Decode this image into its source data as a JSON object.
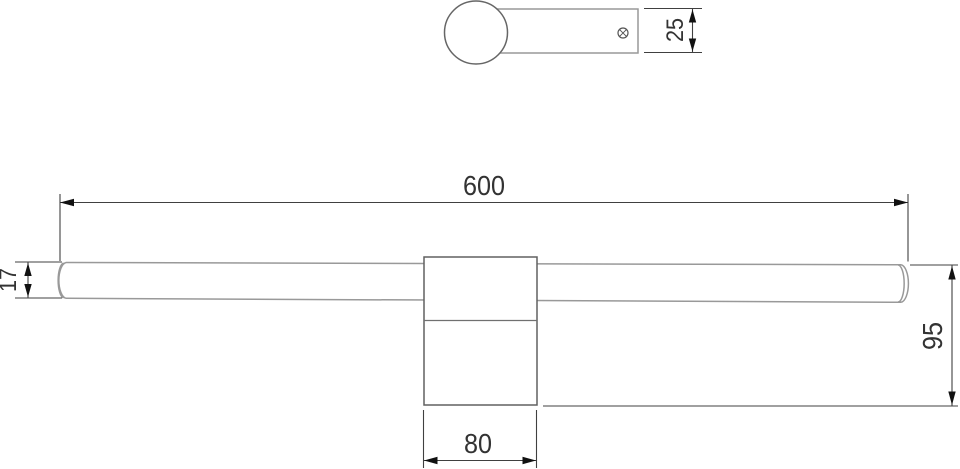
{
  "colors": {
    "background": "#ffffff",
    "object_line": "#999999",
    "object_line_dark": "#606060",
    "dimension_line": "#404040",
    "arrow": "#111111",
    "text": "#333333"
  },
  "top_view": {
    "dim_depth": "25"
  },
  "front_view": {
    "dim_length": "600",
    "dim_bar_height": "17",
    "dim_body_width": "80",
    "dim_total_height": "95"
  }
}
